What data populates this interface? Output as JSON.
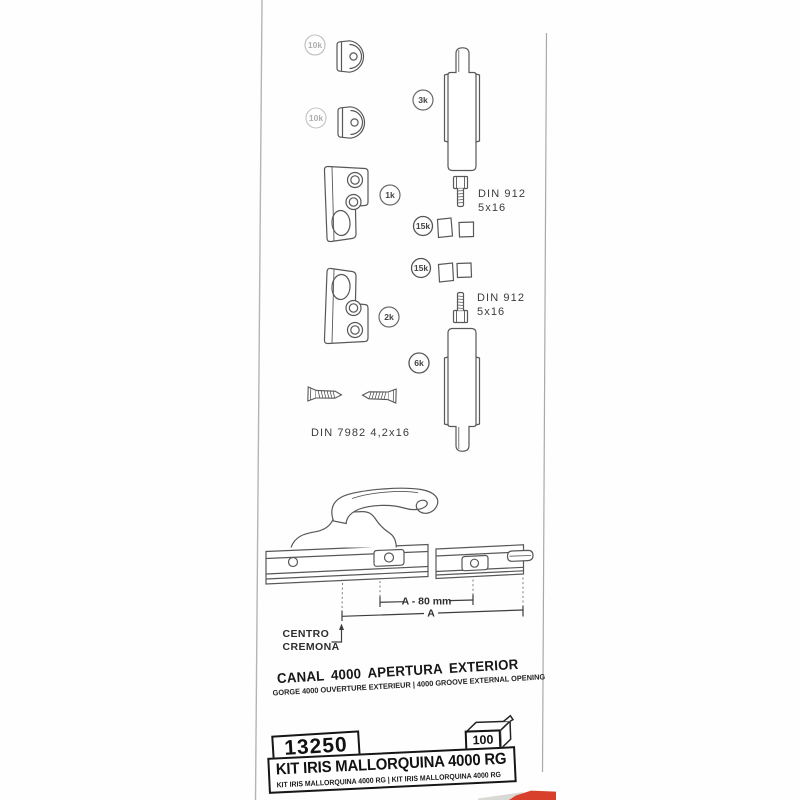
{
  "diagram": {
    "part_labels": {
      "endcap_top": "10k",
      "endcap_bottom": "10k",
      "latch_upper": "3k",
      "keeper_upper": "1k",
      "shims_upper": "15k",
      "shims_lower": "15k",
      "keeper_lower": "2k",
      "latch_lower": "6k"
    },
    "hardware_notes": {
      "bolt_upper_line1": "DIN 912",
      "bolt_upper_line2": "5x16",
      "bolt_lower_line1": "DIN 912",
      "bolt_lower_line2": "5x16",
      "screws": "DIN 7982  4,2x16"
    },
    "dimensions": {
      "inner_span": "A - 80 mm",
      "outer_span": "A",
      "reference_line1": "CENTRO",
      "reference_line2": "CREMONA"
    }
  },
  "titles": {
    "main": "CANAL 4000  APERTURA EXTERIOR",
    "subtitle": "GORGE 4000 OUVERTURE EXTERIEUR | 4000 GROOVE EXTERNAL OPENING"
  },
  "product": {
    "code": "13250",
    "carton_quantity": "100",
    "name": "KIT IRIS MALLORQUINA 4000 RG",
    "name_translations": "KIT IRIS MALLORQUINA 4000 RG | KIT IRIS MALLORQUINA 4000 RG"
  },
  "colors": {
    "line_art": "#585858",
    "ink": "#1c1c1c",
    "accent_red": "#d8402c"
  }
}
